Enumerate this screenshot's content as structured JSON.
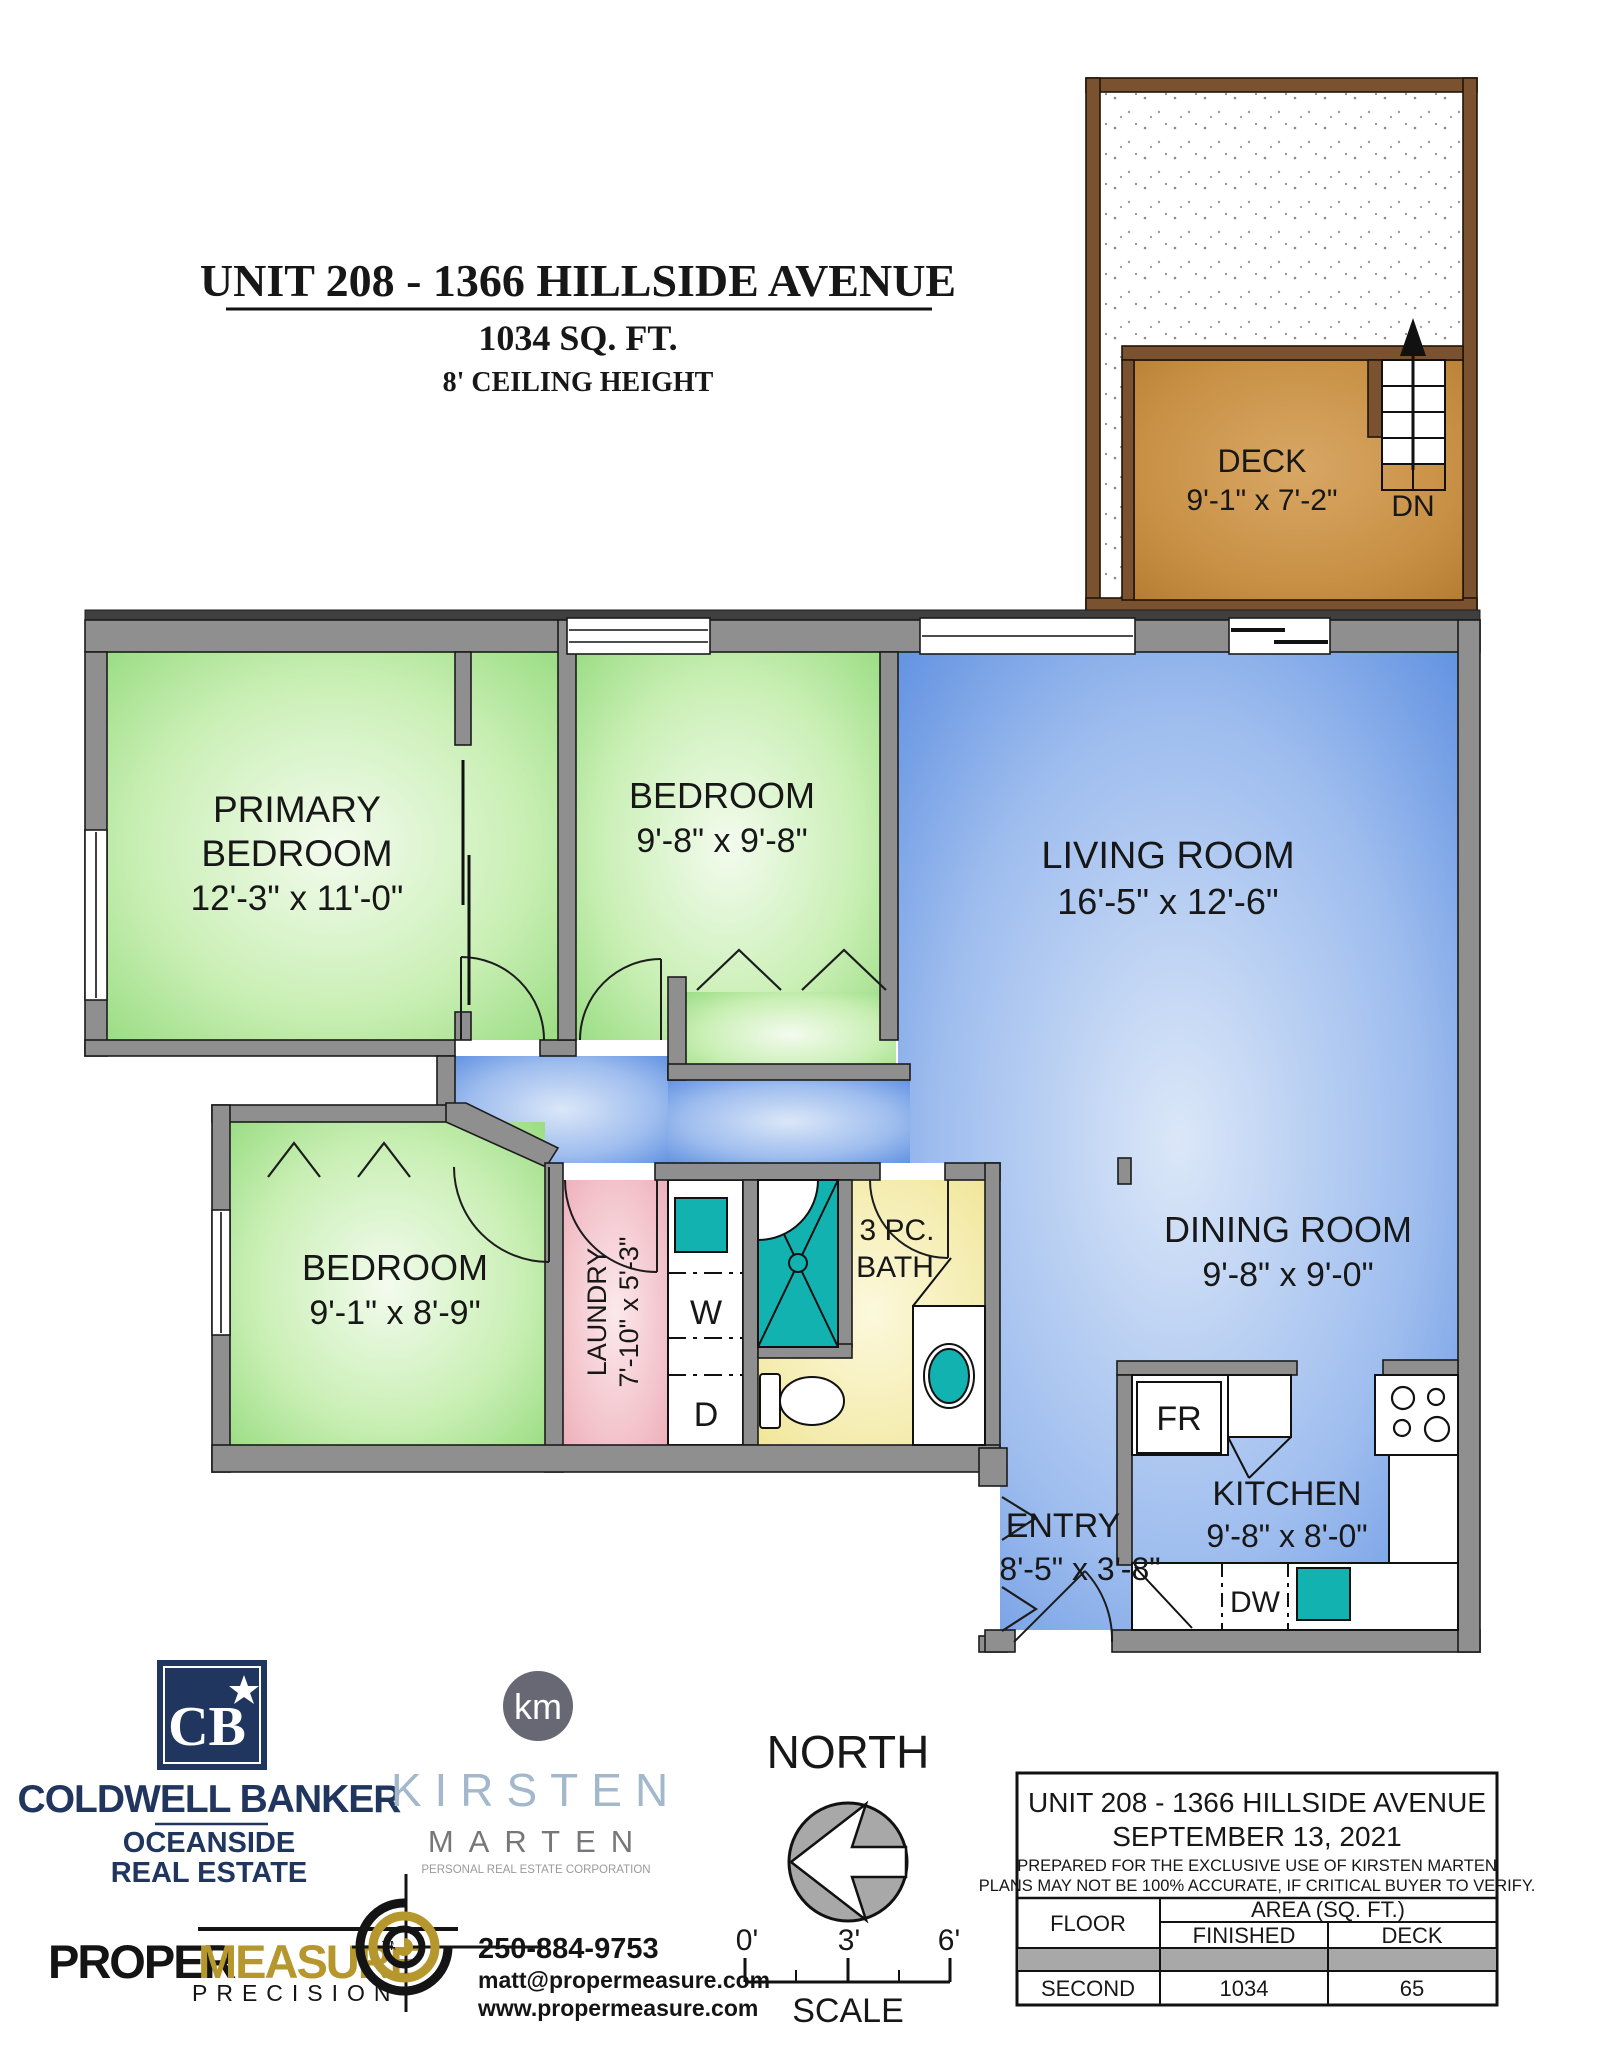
{
  "title_block": {
    "title": "UNIT 208 - 1366 HILLSIDE AVENUE",
    "area": "1034 SQ. FT.",
    "ceiling": "8' CEILING HEIGHT"
  },
  "deck": {
    "name": "DECK",
    "dims": "9'-1\" x 7'-2\"",
    "down": "DN"
  },
  "rooms": {
    "primary": {
      "line1": "PRIMARY",
      "line2": "BEDROOM",
      "dims": "12'-3\" x 11'-0\""
    },
    "bedroom2": {
      "name": "BEDROOM",
      "dims": "9'-8\" x 9'-8\""
    },
    "living": {
      "name": "LIVING ROOM",
      "dims": "16'-5\" x 12'-6\""
    },
    "dining": {
      "name": "DINING ROOM",
      "dims": "9'-8\" x 9'-0\""
    },
    "bedroom3": {
      "name": "BEDROOM",
      "dims": "9'-1\" x 8'-9\""
    },
    "laundry": {
      "name": "LAUNDRY",
      "dims": "7'-10\" x 5'-3\""
    },
    "bath": {
      "line1": "3 PC.",
      "line2": "BATH"
    },
    "kitchen": {
      "name": "KITCHEN",
      "dims": "9'-8\" x 8'-0\""
    },
    "entry": {
      "name": "ENTRY",
      "dims": "8'-5\" x 3'-8\""
    }
  },
  "fixtures": {
    "washer": "W",
    "dryer": "D",
    "fridge": "FR",
    "dishwasher": "DW"
  },
  "compass": {
    "label": "NORTH"
  },
  "scale_bar": {
    "tick_start": "0'",
    "tick_mid": "3'",
    "tick_end": "6'",
    "label": "SCALE"
  },
  "brands": {
    "coldwell": {
      "monogram": "CB",
      "name": "COLDWELL BANKER",
      "sub1": "OCEANSIDE",
      "sub2": "REAL ESTATE"
    },
    "kirsten": {
      "monogram": "km",
      "first_name": "KIRSTEN",
      "last_name": "MARTEN",
      "tagline": "PERSONAL REAL ESTATE CORPORATION"
    },
    "propermeasure": {
      "word1": "PROPER",
      "word2": "MEASURE",
      "tm": "TM",
      "tagline": "PRECISION"
    },
    "contact": {
      "phone": "250-884-9753",
      "email": "matt@propermeasure.com",
      "website": "www.propermeasure.com"
    }
  },
  "info_table": {
    "title": "UNIT 208 - 1366 HILLSIDE AVENUE",
    "date": "SEPTEMBER 13, 2021",
    "note1": "PREPARED FOR THE EXCLUSIVE USE OF KIRSTEN MARTEN",
    "note2": "PLANS MAY NOT BE 100% ACCURATE, IF CRITICAL BUYER TO VERIFY.",
    "header_floor": "FLOOR",
    "header_area": "AREA (SQ. FT.)",
    "header_finished": "FINISHED",
    "header_deck": "DECK",
    "row": {
      "floor": "SECOND",
      "finished": "1034",
      "deck": "65"
    }
  },
  "colors": {
    "wall_gray": "#8f8f8f",
    "bedroom_green": "#8fd878",
    "living_blue": "#4e84dd",
    "laundry_pink": "#eba7b5",
    "bath_yellow": "#eee189",
    "fixture_teal": "#12b2b0",
    "deck_brown": "#7a5230",
    "deck_floor": "#c89045",
    "coldwell_navy": "#20365f",
    "propermeasure_gold": "#b5972e",
    "kirsten_blue": "#a3b8cb"
  }
}
